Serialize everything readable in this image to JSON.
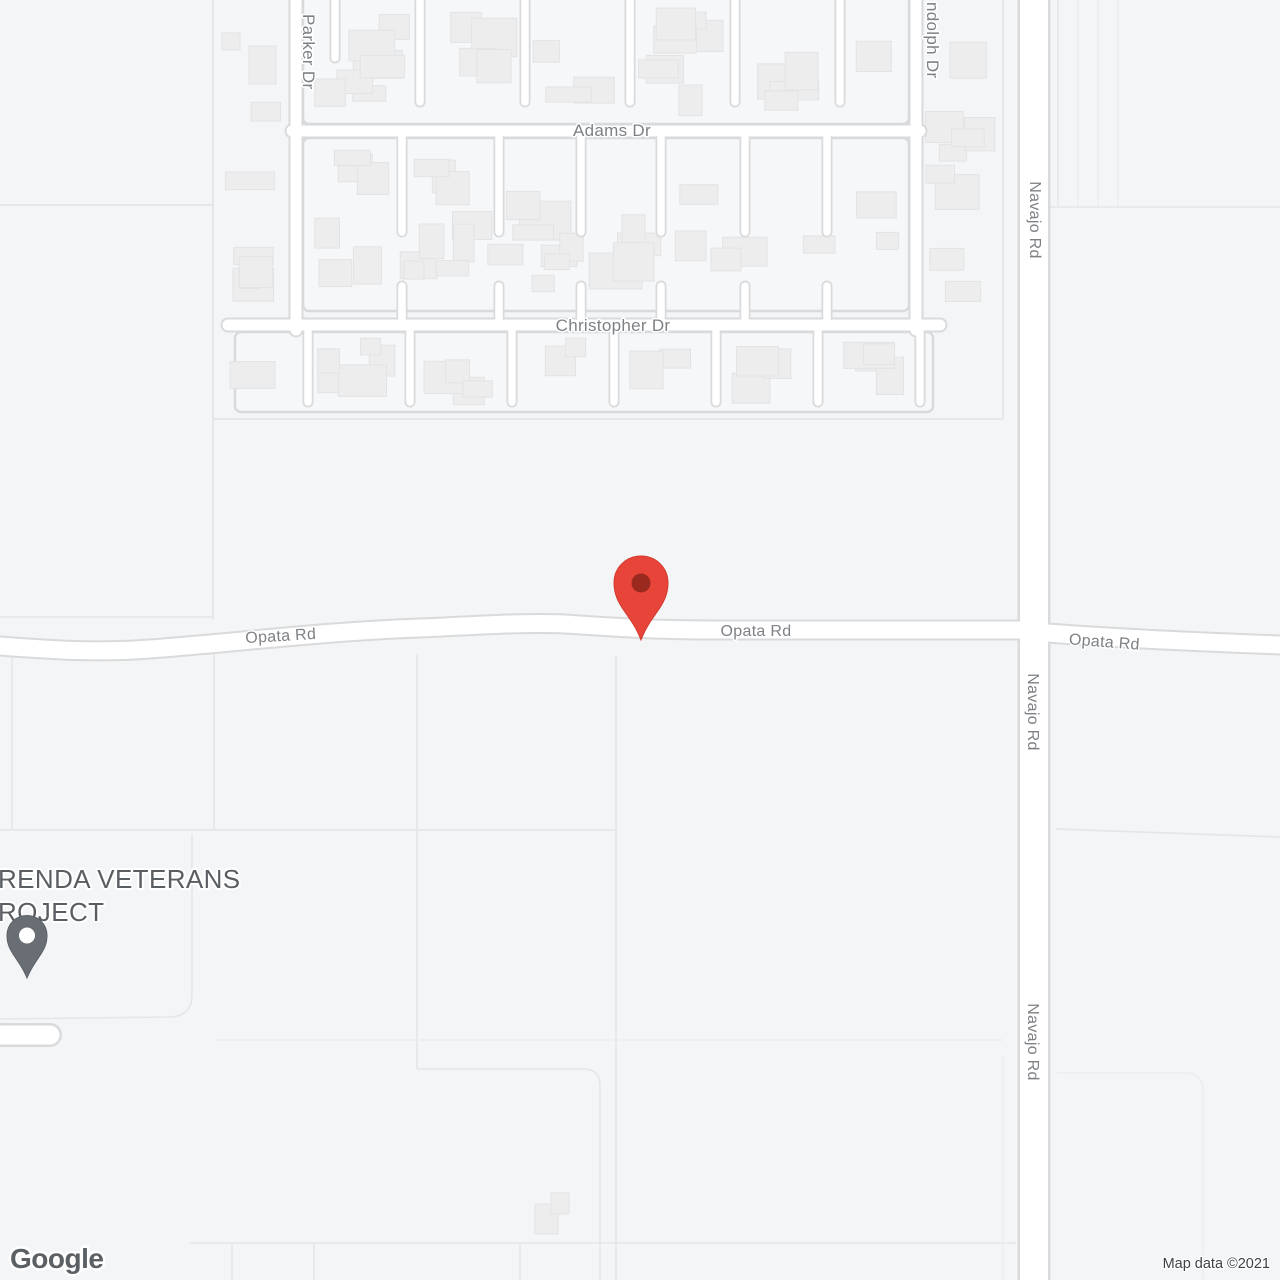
{
  "map": {
    "streets": {
      "parker": "Parker Dr",
      "adams": "Adams Dr",
      "christopher": "Christopher Dr",
      "randolph_visible": "ndolph Dr",
      "navajo": "Navajo Rd",
      "opata": "Opata Rd"
    },
    "poi": {
      "name_line1": "RENDA VETERANS",
      "name_line2": "ROJECT"
    },
    "markers": {
      "destination": {
        "color": "#E8453A",
        "stroke": "#D2392F",
        "inner_dot_color": "#9A2A1D"
      },
      "poi": {
        "color": "#686E74",
        "stroke": "#5A6065",
        "inner_dot_color": "#FFFFFF"
      }
    },
    "attribution": {
      "logo": "Google",
      "copyright": "Map data ©2021"
    },
    "colors": {
      "background": "#F4F5F6",
      "lot_fill": "#F6F7F8",
      "building_fill": "#EDEDEE",
      "building_stroke": "#E2E3E5",
      "road_fill": "#FFFFFF",
      "road_casing": "#D8DADC",
      "parcel_line": "#E5E6E8",
      "parcel_line_faint": "#ECEDEE",
      "label_gray": "#7D8185"
    }
  }
}
